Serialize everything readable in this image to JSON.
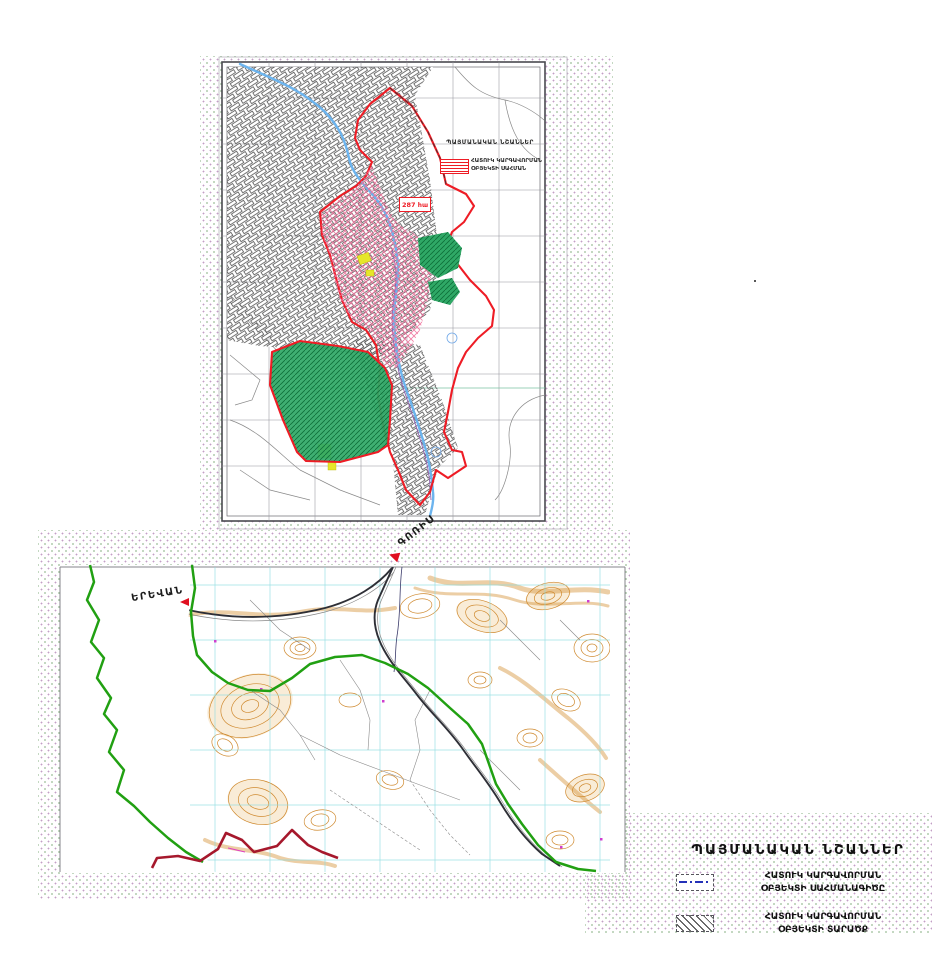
{
  "colors": {
    "boundary_red": "#ee1c25",
    "hatch_pink": "#ef6f9a",
    "hatch_cyan": "#66c2da",
    "green_area": "#2fa866",
    "green_hatch": "#0d6e38",
    "river_blue": "#6cb4ee",
    "green_line": "#21a012",
    "maroon_line": "#a6182c",
    "contour": "#cf8a30",
    "cyan_grid": "#8adce0",
    "legend_blue": "#2431b8",
    "dot1": "#c39fc6",
    "dot2": "#a4c2a0"
  },
  "top_map": {
    "area_label": "287 հա",
    "legend": {
      "title": "ՊԱՅՄԱՆԱԿԱՆ ՆՇԱՆՆԵՐ",
      "item_line1": "ՀԱՏՈՒԿ ԿԱՐԳԱՎՈՐՄԱՆ",
      "item_line2": "ՕԲՅԵԿՏԻ ՍԱՀՄԱՆ"
    }
  },
  "lower_map": {
    "labels": {
      "goris": "ԳՈՌԻՍ",
      "yerevan": "ԵՐԵՎԱՆ"
    }
  },
  "legend": {
    "title": "ՊԱՅՄԱՆԱԿԱՆ ՆՇԱՆՆԵՐ",
    "items": [
      {
        "symbol": "boundary-line",
        "line1": "ՀԱՏՈՒԿ ԿԱՐԳԱՎՈՐՄԱՆ",
        "line2": "ՕԲՅԵԿՏԻ ՍԱՀՄԱՆԱԳԻԾԸ"
      },
      {
        "symbol": "hatched-area",
        "line1": "ՀԱՏՈՒԿ ԿԱՐԳԱՎՈՐՄԱՆ",
        "line2": "ՕԲՅԵԿՏԻ ՏԱՐԱԾՔ"
      }
    ]
  }
}
